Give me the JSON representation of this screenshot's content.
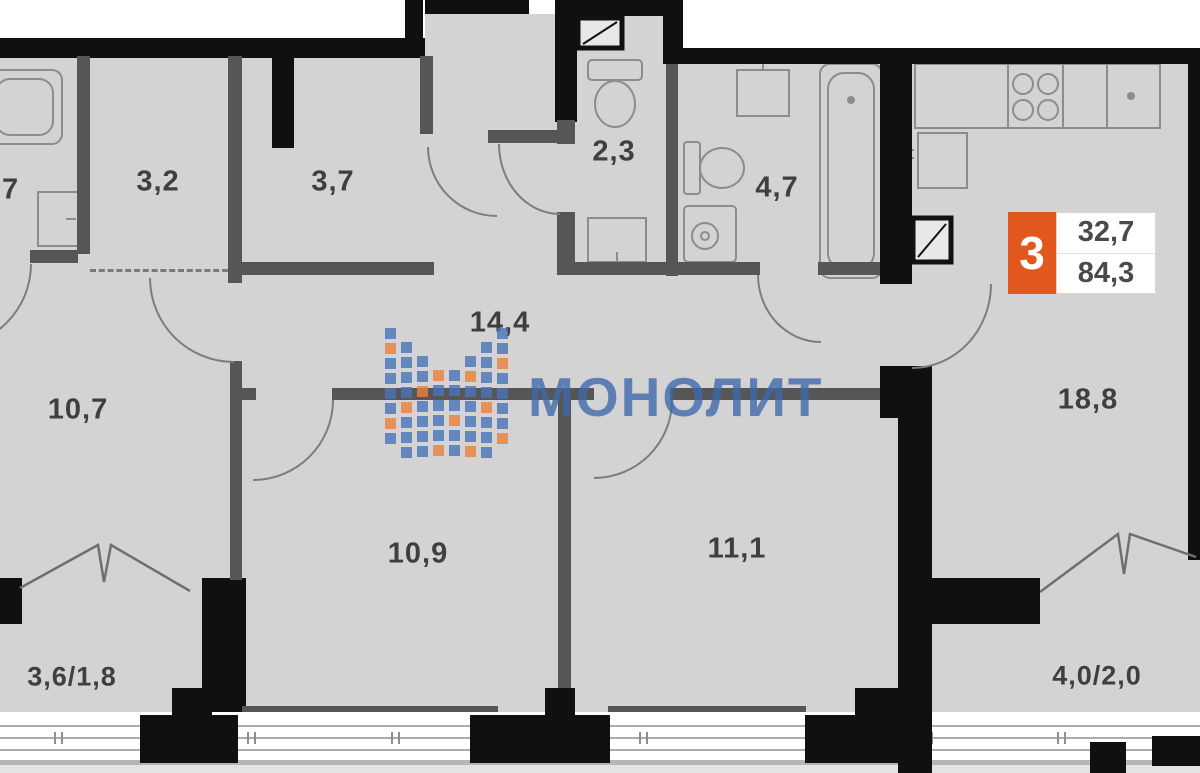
{
  "floorplan": {
    "brand": "МОНОЛИТ",
    "badge": {
      "rooms": "3",
      "area_top": "32,7",
      "area_bottom": "84,3"
    },
    "labels": {
      "bath_left": ",7",
      "wardrobe": "3,2",
      "hall_top": "3,7",
      "wc": "2,3",
      "bathroom": "4,7",
      "hallway": "14,4",
      "corridor": "10,7",
      "bedroom1": "10,9",
      "bedroom2": "11,1",
      "kitchen_living": "18,8",
      "balcony_left": "3,6/1,8",
      "balcony_right": "4,0/2,0"
    },
    "colors": {
      "accent_orange": "#e2571d",
      "logo_blue": "#4a74b8",
      "logo_orange": "#e8813c",
      "floor": "#d3d3d3",
      "wall": "#101010"
    }
  }
}
